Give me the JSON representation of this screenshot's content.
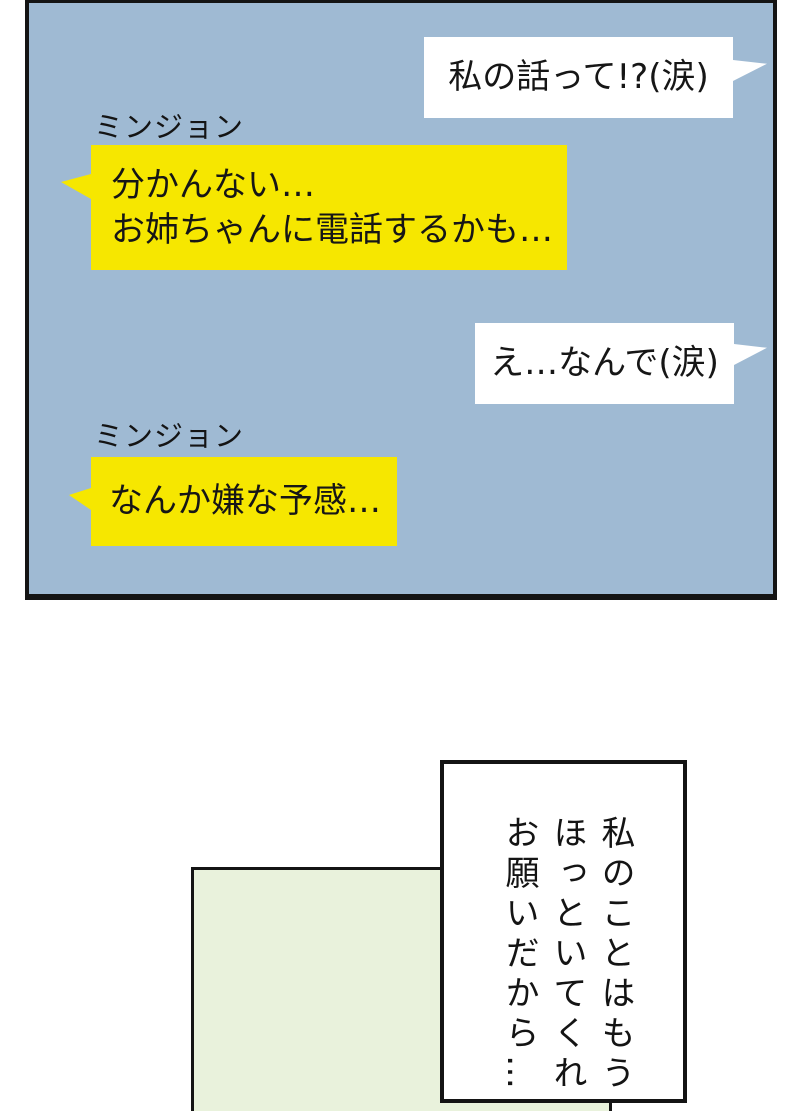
{
  "page": {
    "background": "#ffffff"
  },
  "chat_panel": {
    "background": "#9fbad3",
    "border_color": "#141414",
    "white_bubble_color": "#ffffff",
    "yellow_bubble_color": "#f6e700",
    "bubbles": [
      {
        "style": "white",
        "align": "right",
        "text": "私の話って!?(涙)"
      },
      {
        "style": "yellow",
        "align": "left",
        "sender": "ミンジョン",
        "lines": [
          "分かんない…",
          "お姉ちゃんに電話するかも…"
        ]
      },
      {
        "style": "white",
        "align": "right",
        "text": "え…なんで(涙)"
      },
      {
        "style": "yellow",
        "align": "left",
        "sender": "ミンジョン",
        "lines": [
          "なんか嫌な予感…"
        ]
      }
    ]
  },
  "bottom_section": {
    "green_panel": {
      "background": "#e9f2dc",
      "border_color": "#141414"
    },
    "narration_box": {
      "background": "#ffffff",
      "border_color": "#141414",
      "vertical_text": [
        "私のことはもう",
        "ほっといてくれ",
        "お願いだから…"
      ]
    }
  }
}
